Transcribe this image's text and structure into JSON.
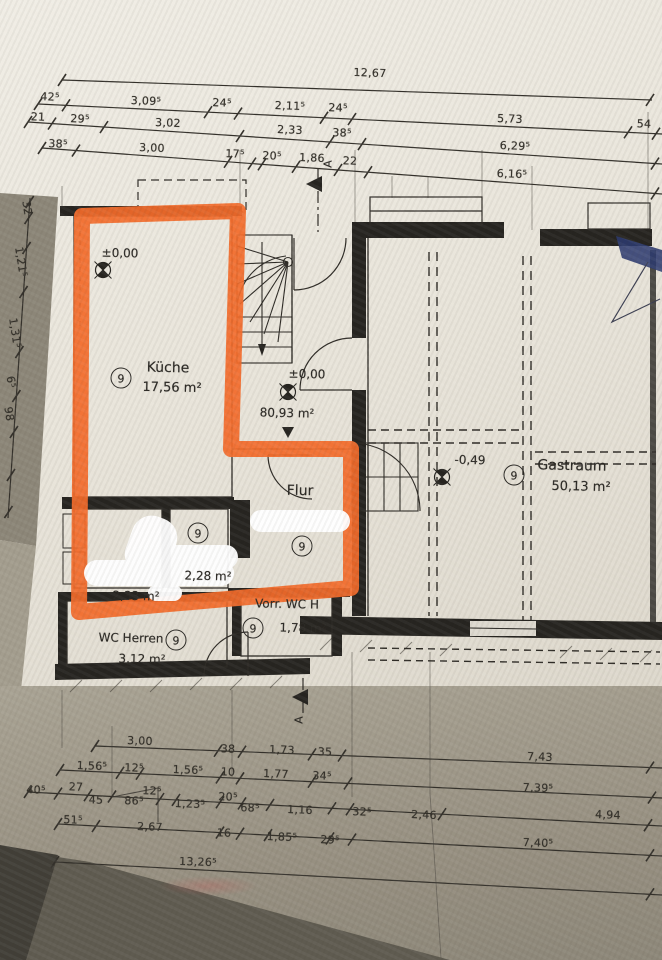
{
  "highlight": {
    "color": "#f26a2a"
  },
  "rooms": {
    "kueche": {
      "number": "9",
      "name": "Küche",
      "area": "17,56 m²"
    },
    "flur": {
      "number": "9",
      "name": "Flur"
    },
    "room_228": {
      "number": "9",
      "area": "2,28 m²"
    },
    "room_233": {
      "area": "2,33 m²"
    },
    "vorr_wc": {
      "number": "9",
      "name": "Vorr. WC H",
      "area": "1,78 m²"
    },
    "wc_herren": {
      "number": "9",
      "name": "WC Herren",
      "area": "3,12 m²"
    },
    "gastraum": {
      "number": "9",
      "name": "Gastraum",
      "area": "50,13 m²"
    }
  },
  "levels": {
    "kueche": "±0,00",
    "hall": "±0,00",
    "gastraum": "-0,49"
  },
  "hall_area": "80,93 m²",
  "section_label": "A",
  "dim_labels": [
    {
      "t": "12,67",
      "x": 370,
      "y": 73,
      "r": 2
    },
    {
      "t": "42⁵",
      "x": 50,
      "y": 97,
      "r": 2
    },
    {
      "t": "3,09⁵",
      "x": 146,
      "y": 101,
      "r": 2
    },
    {
      "t": "24⁵",
      "x": 222,
      "y": 103,
      "r": 2
    },
    {
      "t": "2,11⁵",
      "x": 290,
      "y": 106,
      "r": 2
    },
    {
      "t": "24⁵",
      "x": 338,
      "y": 108,
      "r": 2
    },
    {
      "t": "5,73",
      "x": 510,
      "y": 119,
      "r": 2
    },
    {
      "t": "54",
      "x": 644,
      "y": 124,
      "r": 2
    },
    {
      "t": "21",
      "x": 38,
      "y": 117,
      "r": 2
    },
    {
      "t": "29⁵",
      "x": 80,
      "y": 119,
      "r": 2
    },
    {
      "t": "3,02",
      "x": 168,
      "y": 123,
      "r": 2
    },
    {
      "t": "2,33",
      "x": 290,
      "y": 130,
      "r": 2
    },
    {
      "t": "38⁵",
      "x": 342,
      "y": 133,
      "r": 2
    },
    {
      "t": "6,29⁵",
      "x": 515,
      "y": 146,
      "r": 2
    },
    {
      "t": "38⁵",
      "x": 58,
      "y": 144,
      "r": 2
    },
    {
      "t": "3,00",
      "x": 152,
      "y": 148,
      "r": 2
    },
    {
      "t": "17⁵",
      "x": 235,
      "y": 154,
      "r": 2
    },
    {
      "t": "20⁵",
      "x": 272,
      "y": 156,
      "r": 2
    },
    {
      "t": "1,86",
      "x": 312,
      "y": 158,
      "r": 2
    },
    {
      "t": "22",
      "x": 350,
      "y": 161,
      "r": 2
    },
    {
      "t": "6,16⁵",
      "x": 512,
      "y": 174,
      "r": 2
    },
    {
      "t": "3,00",
      "x": 140,
      "y": 741,
      "r": 2
    },
    {
      "t": "38",
      "x": 228,
      "y": 749,
      "r": 2
    },
    {
      "t": "1,73",
      "x": 282,
      "y": 750,
      "r": 2
    },
    {
      "t": "35",
      "x": 325,
      "y": 752,
      "r": 2
    },
    {
      "t": "7,43",
      "x": 540,
      "y": 757,
      "r": 2
    },
    {
      "t": "1,56⁵",
      "x": 92,
      "y": 766,
      "r": 2
    },
    {
      "t": "12⁵",
      "x": 134,
      "y": 768,
      "r": 2
    },
    {
      "t": "1,56⁵",
      "x": 188,
      "y": 770,
      "r": 2
    },
    {
      "t": "10",
      "x": 228,
      "y": 772,
      "r": 2
    },
    {
      "t": "1,77",
      "x": 276,
      "y": 774,
      "r": 2
    },
    {
      "t": "34⁵",
      "x": 322,
      "y": 776,
      "r": 2
    },
    {
      "t": "7,39⁵",
      "x": 538,
      "y": 788,
      "r": 2
    },
    {
      "t": "40⁵",
      "x": 36,
      "y": 790,
      "r": 2
    },
    {
      "t": "27",
      "x": 76,
      "y": 787,
      "r": 2
    },
    {
      "t": "45",
      "x": 96,
      "y": 800,
      "r": 2
    },
    {
      "t": "86⁵",
      "x": 134,
      "y": 801,
      "r": 2
    },
    {
      "t": "12⁵",
      "x": 152,
      "y": 791,
      "r": 2
    },
    {
      "t": "1,23⁵",
      "x": 190,
      "y": 804,
      "r": 2
    },
    {
      "t": "20⁵",
      "x": 228,
      "y": 797,
      "r": 2
    },
    {
      "t": "68⁵",
      "x": 250,
      "y": 808,
      "r": 2
    },
    {
      "t": "1,16",
      "x": 300,
      "y": 810,
      "r": 2
    },
    {
      "t": "32⁵",
      "x": 362,
      "y": 812,
      "r": 2
    },
    {
      "t": "2,46",
      "x": 424,
      "y": 815,
      "r": 2
    },
    {
      "t": "4,94",
      "x": 608,
      "y": 815,
      "r": 2
    },
    {
      "t": "51⁵",
      "x": 73,
      "y": 820,
      "r": 2
    },
    {
      "t": "2,67",
      "x": 150,
      "y": 827,
      "r": 2
    },
    {
      "t": "16",
      "x": 224,
      "y": 833,
      "r": 2
    },
    {
      "t": "1,85⁵",
      "x": 282,
      "y": 837,
      "r": 2
    },
    {
      "t": "29⁵",
      "x": 330,
      "y": 840,
      "r": 2
    },
    {
      "t": "7,40⁵",
      "x": 538,
      "y": 843,
      "r": 2
    },
    {
      "t": "13,26⁵",
      "x": 198,
      "y": 862,
      "r": 2
    },
    {
      "t": "32",
      "x": 27,
      "y": 208,
      "r": 81
    },
    {
      "t": "1,21⁵",
      "x": 21,
      "y": 262,
      "r": 81
    },
    {
      "t": "1,31⁵",
      "x": 15,
      "y": 333,
      "r": 81
    },
    {
      "t": "6⁵",
      "x": 11,
      "y": 382,
      "r": 81
    },
    {
      "t": "98",
      "x": 9,
      "y": 414,
      "r": 81
    }
  ],
  "dim_lines": [
    {
      "x1": 62,
      "y1": 80,
      "x2": 652,
      "y2": 100,
      "ticks": [
        62,
        650
      ]
    },
    {
      "x1": 38,
      "y1": 104,
      "x2": 662,
      "y2": 134,
      "ticks": [
        38,
        66,
        208,
        238,
        324,
        352,
        628,
        656
      ]
    },
    {
      "x1": 28,
      "y1": 122,
      "x2": 662,
      "y2": 164,
      "ticks": [
        28,
        52,
        104,
        240,
        330,
        362,
        655
      ]
    },
    {
      "x1": 42,
      "y1": 148,
      "x2": 662,
      "y2": 194,
      "ticks": [
        42,
        76,
        228,
        252,
        262,
        296,
        338,
        368,
        655
      ]
    },
    {
      "x1": 95,
      "y1": 746,
      "x2": 662,
      "y2": 768,
      "ticks": [
        95,
        218,
        242,
        312,
        342,
        650
      ]
    },
    {
      "x1": 60,
      "y1": 770,
      "x2": 662,
      "y2": 798,
      "ticks": [
        60,
        120,
        140,
        220,
        240,
        312,
        348,
        652
      ]
    },
    {
      "x1": 28,
      "y1": 792,
      "x2": 662,
      "y2": 826,
      "ticks": [
        28,
        58,
        88,
        112,
        160,
        176,
        220,
        242,
        270,
        332,
        350,
        442,
        648
      ]
    },
    {
      "x1": 58,
      "y1": 824,
      "x2": 662,
      "y2": 856,
      "ticks": [
        58,
        96,
        220,
        240,
        268,
        330,
        352,
        650
      ]
    },
    {
      "x1": 55,
      "y1": 862,
      "x2": 662,
      "y2": 895,
      "ticks": [
        55,
        650
      ]
    },
    {
      "x1": 30,
      "y1": 198,
      "x2": 8,
      "y2": 518,
      "ticks": [
        202,
        218,
        248,
        292,
        352,
        396,
        432,
        475,
        512
      ]
    }
  ]
}
